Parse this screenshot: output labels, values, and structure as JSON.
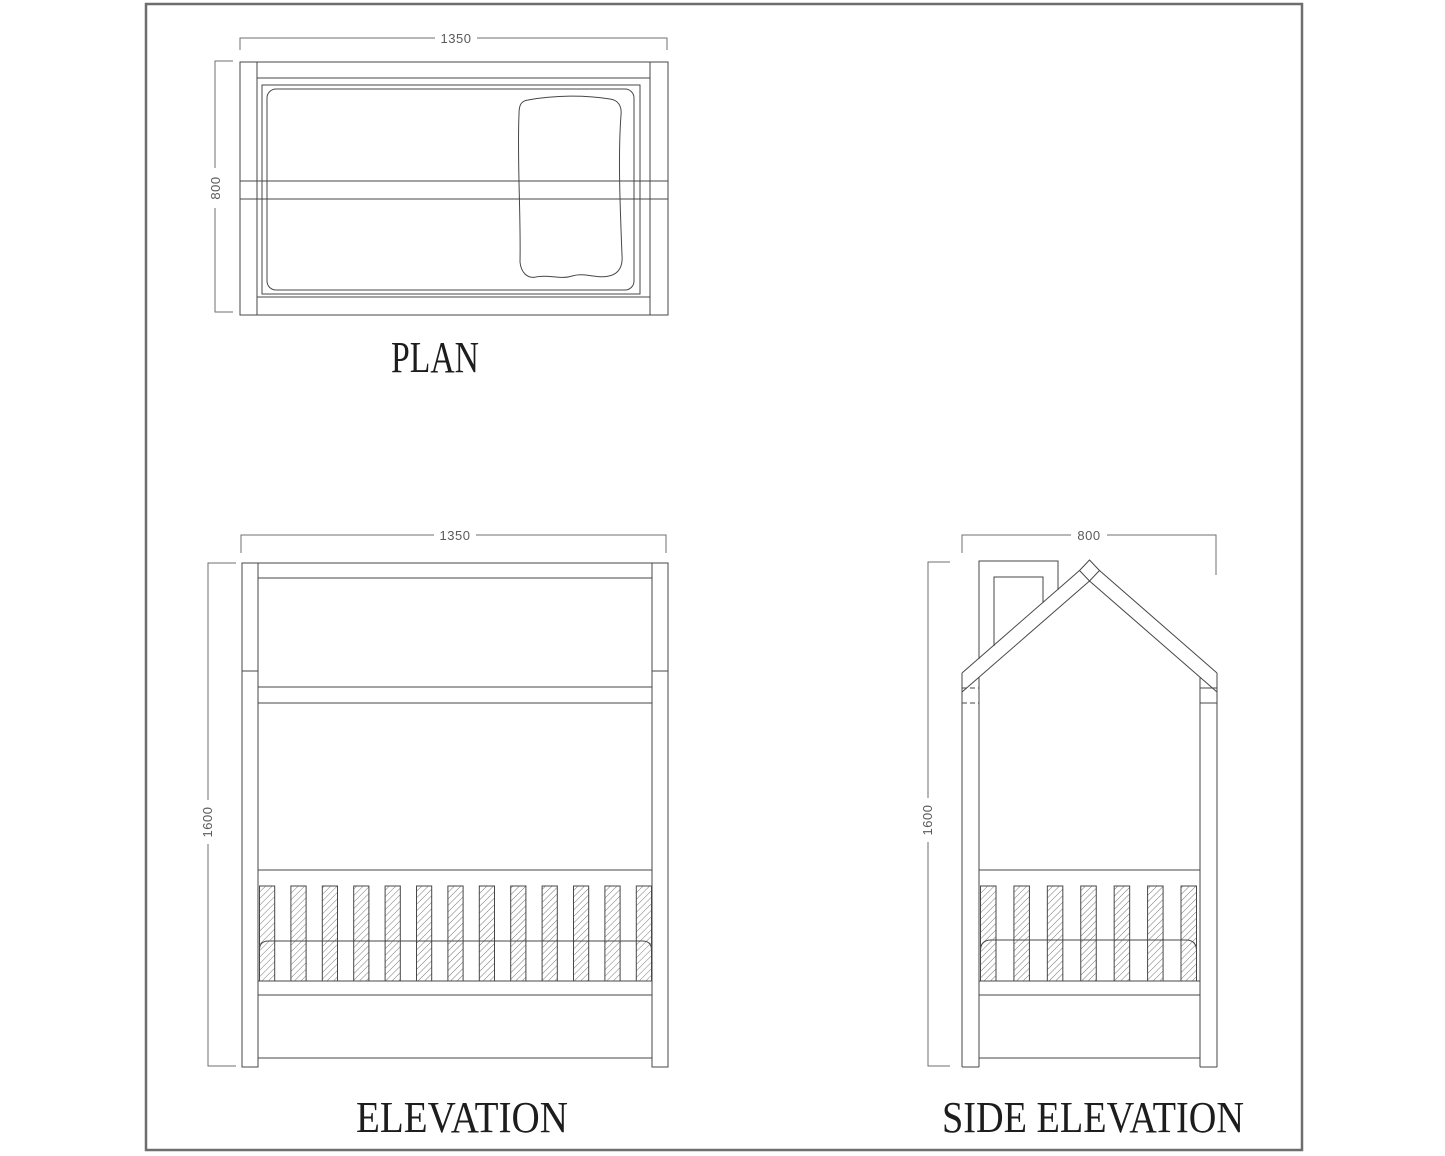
{
  "sheet": {
    "background": "#ffffff",
    "border_color": "#6e6e6e",
    "line_color": "#474747",
    "dim_color": "#6f6f6f",
    "label_color": "#1d1d1d",
    "hatch_style": "diagonal-lines"
  },
  "views": {
    "plan": {
      "label": "PLAN",
      "width_dim": "1350",
      "height_dim": "800",
      "features": [
        "bed-frame",
        "mattress",
        "pillow",
        "cross-rail"
      ]
    },
    "elevation": {
      "label": "ELEVATION",
      "width_dim": "1350",
      "height_dim": "1600",
      "slat_count": 13,
      "features": [
        "posts",
        "top-beam",
        "head-rail",
        "hatched-slats",
        "mattress",
        "base-rails"
      ]
    },
    "side_elevation": {
      "label": "SIDE ELEVATION",
      "width_dim": "800",
      "height_dim": "1600",
      "slat_count": 7,
      "features": [
        "gable-roof",
        "roof-apex",
        "chimney",
        "posts",
        "hatched-slats",
        "mattress",
        "base-rails"
      ]
    }
  }
}
